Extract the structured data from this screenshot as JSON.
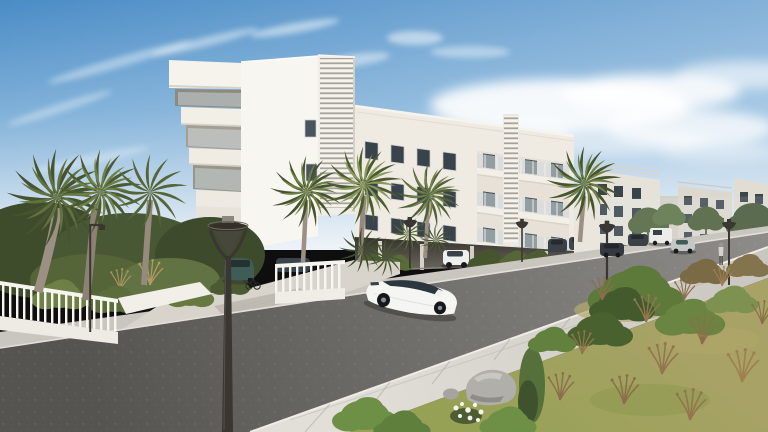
{
  "scene": {
    "kind": "architectural-exterior-3d-render",
    "setting": "Sunny Mediterranean residential street with a modern white apartment complex, palm trees and a wild green verge",
    "time_of_day": "day, clear blue sky with wispy clouds",
    "main_building": "white 4-storey apartment block with two louvered stair towers, glass balconies and open ground-floor parking",
    "distant_buildings": 4,
    "street_lamps": 6,
    "palm_trees": 10,
    "pedestrians": 1,
    "vehicles": {
      "white_hatchback_driving": 1,
      "teal_hatchback_parked": 1,
      "cars_parked_under_building": 3,
      "cars_parked_distant": 4,
      "white_van_parked": 1,
      "car_driving_distant": 1
    },
    "foreground": "overgrown grass with bushes, dry plants, grey rocks and white flowers",
    "road": "asphalt street without lane markings, concrete slab sidewalks"
  },
  "colors": {
    "sky_top": "#4a8cc6",
    "sky_mid": "#7fb0d8",
    "sky_horizon": "#e9f0f6",
    "cloud": "#ffffff",
    "building_lit": "#f8f6f0",
    "building_front": "#efebe3",
    "building_distant": "#e6e2d9",
    "louver_stripe": "#a8a39a",
    "window_dark": "#39434b",
    "glass_balcony": "#cfdade",
    "parking_shadow": "#4e4a44",
    "road_near": "#565450",
    "road_far": "#8e8c89",
    "curb": "#e2dfd8",
    "sidewalk_near": "#e2dfd8",
    "sidewalk_far": "#c9c6bf",
    "apron_concrete": "#d8d4cc",
    "wall_white": "#f2efe8",
    "fence_white": "#f8f6f1",
    "lamp_metal": "#3a3733",
    "palm_green": "#61713f",
    "palm_dark": "#45532e",
    "palm_light": "#8a9a5a",
    "shrub_green": "#4e5c33",
    "bush_bright": "#6e8f46",
    "grass_dry_top": "#a8a266",
    "grass_green_low": "#96a155",
    "dry_plant": "#8a6f4b",
    "trunk_grey": "#9b9083",
    "rock_grey": "#b0afa9",
    "flower_white": "#f4f4ec",
    "car_white": "#f5f5f3",
    "car_teal": "#3f5c57",
    "car_dark": "#3a4046",
    "van_white": "#ecece9"
  }
}
